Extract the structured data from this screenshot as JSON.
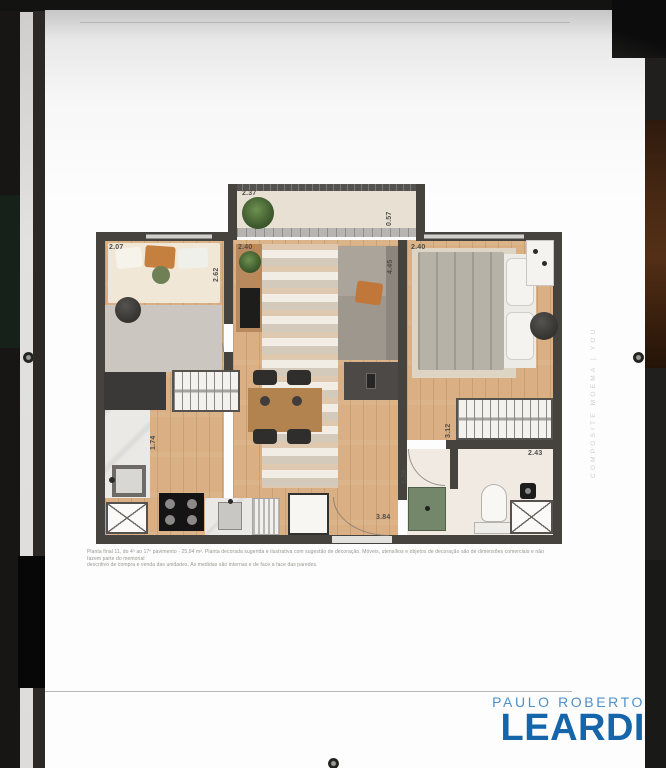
{
  "page": {
    "watermark_vertical": "COMPOSITE MOEMA | YOU",
    "disclaimer_line1": "Planta final 11, do 4º ao 17º pavimento - 25,94 m². Planta decorada sugerida e ilustrativa com sugestão de decoração. Móveis, utensílios e objetos de decoração são de dimensões comerciais e não fazem parte do memorial",
    "disclaimer_line2": "descritivo de compra e venda das unidades. As medidas são internas e de face a face das paredes."
  },
  "logo": {
    "top_line": "PAULO ROBERTO",
    "name": "LEARDI",
    "color_primary": "#1565ab",
    "color_secondary": "#4e90c8"
  },
  "floorplan": {
    "dimensions": {
      "balcony_width": "2.37",
      "balcony_depth": "0.57",
      "bedroom2_width": "2.07",
      "bedroom2_depth": "2.62",
      "living_width": "2.40",
      "living_depth": "4.45",
      "bedroom1_width": "2.40",
      "kitchen_depth": "1.74",
      "closet_width": "3.12",
      "hall_depth": "1.24",
      "bathroom_width": "2.43",
      "corridor_width": "3.84"
    }
  }
}
